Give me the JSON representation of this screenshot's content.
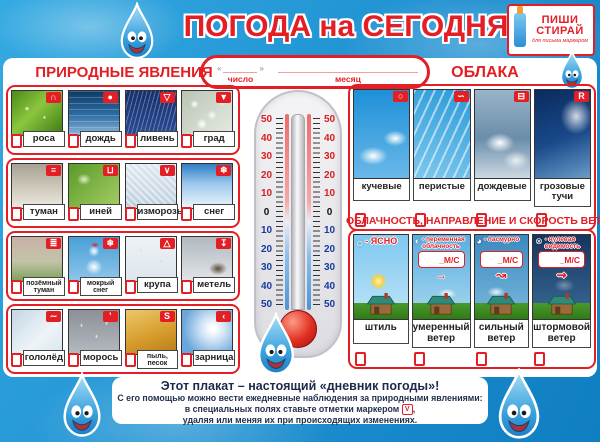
{
  "header": {
    "title": "ПОГОДА на СЕГОДНЯ",
    "logo": {
      "line1": "ПИШИ",
      "line2": "СТИРАЙ",
      "sub": "для письма маркером"
    },
    "date_box": {
      "quote_open": "«",
      "quote_close": "»",
      "day_label": "число",
      "month_label": "месяц"
    }
  },
  "colors": {
    "accent_red": "#e31e24",
    "background_blue": "#1d8fd0",
    "panel_white": "#ffffff"
  },
  "phenomena": {
    "title": "ПРИРОДНЫЕ ЯВЛЕНИЯ",
    "rows": [
      [
        {
          "label": "роса",
          "icon": "∩",
          "photo": "rosa"
        },
        {
          "label": "дождь",
          "icon": "●",
          "photo": "dozhd"
        },
        {
          "label": "ливень",
          "icon": "▽",
          "photo": "liven"
        },
        {
          "label": "град",
          "icon": "▼",
          "photo": "grad"
        }
      ],
      [
        {
          "label": "туман",
          "icon": "≡",
          "photo": "tuman"
        },
        {
          "label": "иней",
          "icon": "⊔",
          "photo": "iney"
        },
        {
          "label": "изморозь",
          "icon": "∨",
          "photo": "izmoroz"
        },
        {
          "label": "снег",
          "icon": "❄",
          "photo": "sneg"
        }
      ],
      [
        {
          "label": "позёмный\nтуман",
          "icon": "≣",
          "photo": "pozyom"
        },
        {
          "label": "мокрый\nснег",
          "icon": "❄",
          "photo": "mokry"
        },
        {
          "label": "крупа",
          "icon": "△",
          "photo": "krupa"
        },
        {
          "label": "метель",
          "icon": "↧",
          "photo": "metel"
        }
      ],
      [
        {
          "label": "гололёд",
          "icon": "∼",
          "photo": "gololyod"
        },
        {
          "label": "морось",
          "icon": "’",
          "photo": "moros"
        },
        {
          "label": "пыль,\nпесок",
          "icon": "S",
          "photo": "pyl"
        },
        {
          "label": "зарница",
          "icon": "‹",
          "photo": "zarnitsa"
        }
      ]
    ]
  },
  "thermometer": {
    "scale": [
      "50",
      "40",
      "30",
      "20",
      "10",
      "0",
      "10",
      "20",
      "30",
      "40",
      "50"
    ]
  },
  "clouds": {
    "title": "ОБЛАКА",
    "items": [
      {
        "label": "кучевые",
        "icon": "○",
        "photo": "kuch"
      },
      {
        "label": "перистые",
        "icon": "∽",
        "photo": "per"
      },
      {
        "label": "дождевые",
        "icon": "⊟",
        "photo": "dozh"
      },
      {
        "label": "грозовые\nтучи",
        "icon": "R",
        "photo": "groz"
      }
    ]
  },
  "wind": {
    "title": "ОБЛАЧНОСТЬ, НАПРАВЛЕНИЕ И СКОРОСТЬ ВЕТРА",
    "items": [
      {
        "circle": "○",
        "legend": "- ЯСНО",
        "bottom": "штиль",
        "photo": "w1"
      },
      {
        "circle": "◐",
        "legend": "- переменная\nоблачность",
        "speed": "_М/С",
        "arrow": "→",
        "bottom": "умеренный\nветер",
        "photo": "w2"
      },
      {
        "circle": "◕",
        "legend": "- пасмурно",
        "speed": "_М/С",
        "arrow": "↝",
        "bottom": "сильный\nветер",
        "photo": "w3"
      },
      {
        "circle": "⊗",
        "legend": "- нулевая\nвидимость",
        "speed": "_М/С",
        "arrow": "⇝",
        "bottom": "штормовой\nветер",
        "photo": "w4"
      }
    ]
  },
  "footer": {
    "bold_line": "Этот плакат – настоящий «дневник погоды»!",
    "line2": "С его помощью можно вести ежедневные наблюдения за природными явлениями:",
    "line3_pre": "в специальных полях ставьте отметки маркером",
    "check_mark": "V",
    "line3_post": ",",
    "line4": "удаляя или меняя их при происходящих изменениях."
  }
}
